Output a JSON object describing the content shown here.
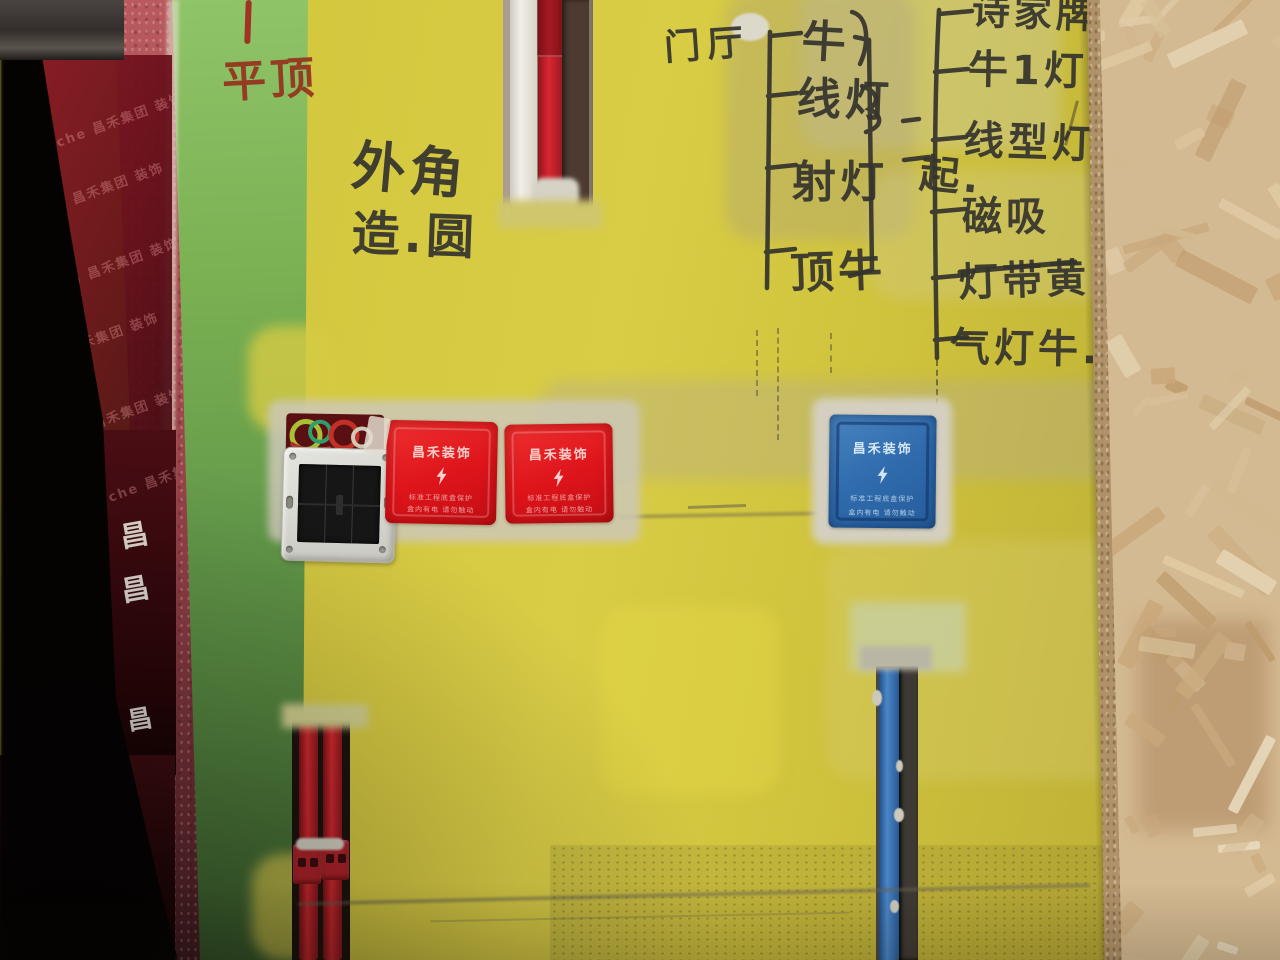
{
  "scene": {
    "type": "construction-site photo",
    "subject": "Rough plastered wall with electrical rough-in: protected outlet boxes, conduits in chases, marker annotations, OSB board on right, red protective film and dark doorway on left"
  },
  "markings": {
    "red_note": "平顶",
    "corner_note_line1": "外角",
    "corner_note_line2": "造.圆",
    "door_hall": {
      "header": "门厅",
      "items": [
        "牛",
        "线灯",
        "射灯",
        "顶牛"
      ],
      "group_label": "起."
    },
    "right_list": {
      "items": [
        "诗家牌",
        "牛1灯",
        "线型灯",
        "磁吸",
        "灯带黄",
        "气灯牛."
      ],
      "strikethrough_item": "灯带黄"
    }
  },
  "covers": {
    "brand": "昌禾装饰",
    "warning_line1": "标准工程底盒保护",
    "warning_line2": "盒内有电 请勿触动",
    "red_hex": "#dd141a",
    "blue_hex": "#2f6bad",
    "bolt_icon": "lightning-bolt"
  },
  "protective_film": {
    "watermark": "hanche 昌禾集团 装饰",
    "logo_mark": "昌",
    "film_hex": "#7c1120"
  },
  "materials": {
    "wall_yellow_hex": "#d3c73e",
    "wall_green_hex": "#7ab052",
    "corner_pink_hex": "#a84d52",
    "pipe_red_hex": "#d32a31",
    "pipe_white_hex": "#f2efe8",
    "pipe_blue_hex": "#3e7cc0",
    "osb_hex": "#d4ba92"
  }
}
